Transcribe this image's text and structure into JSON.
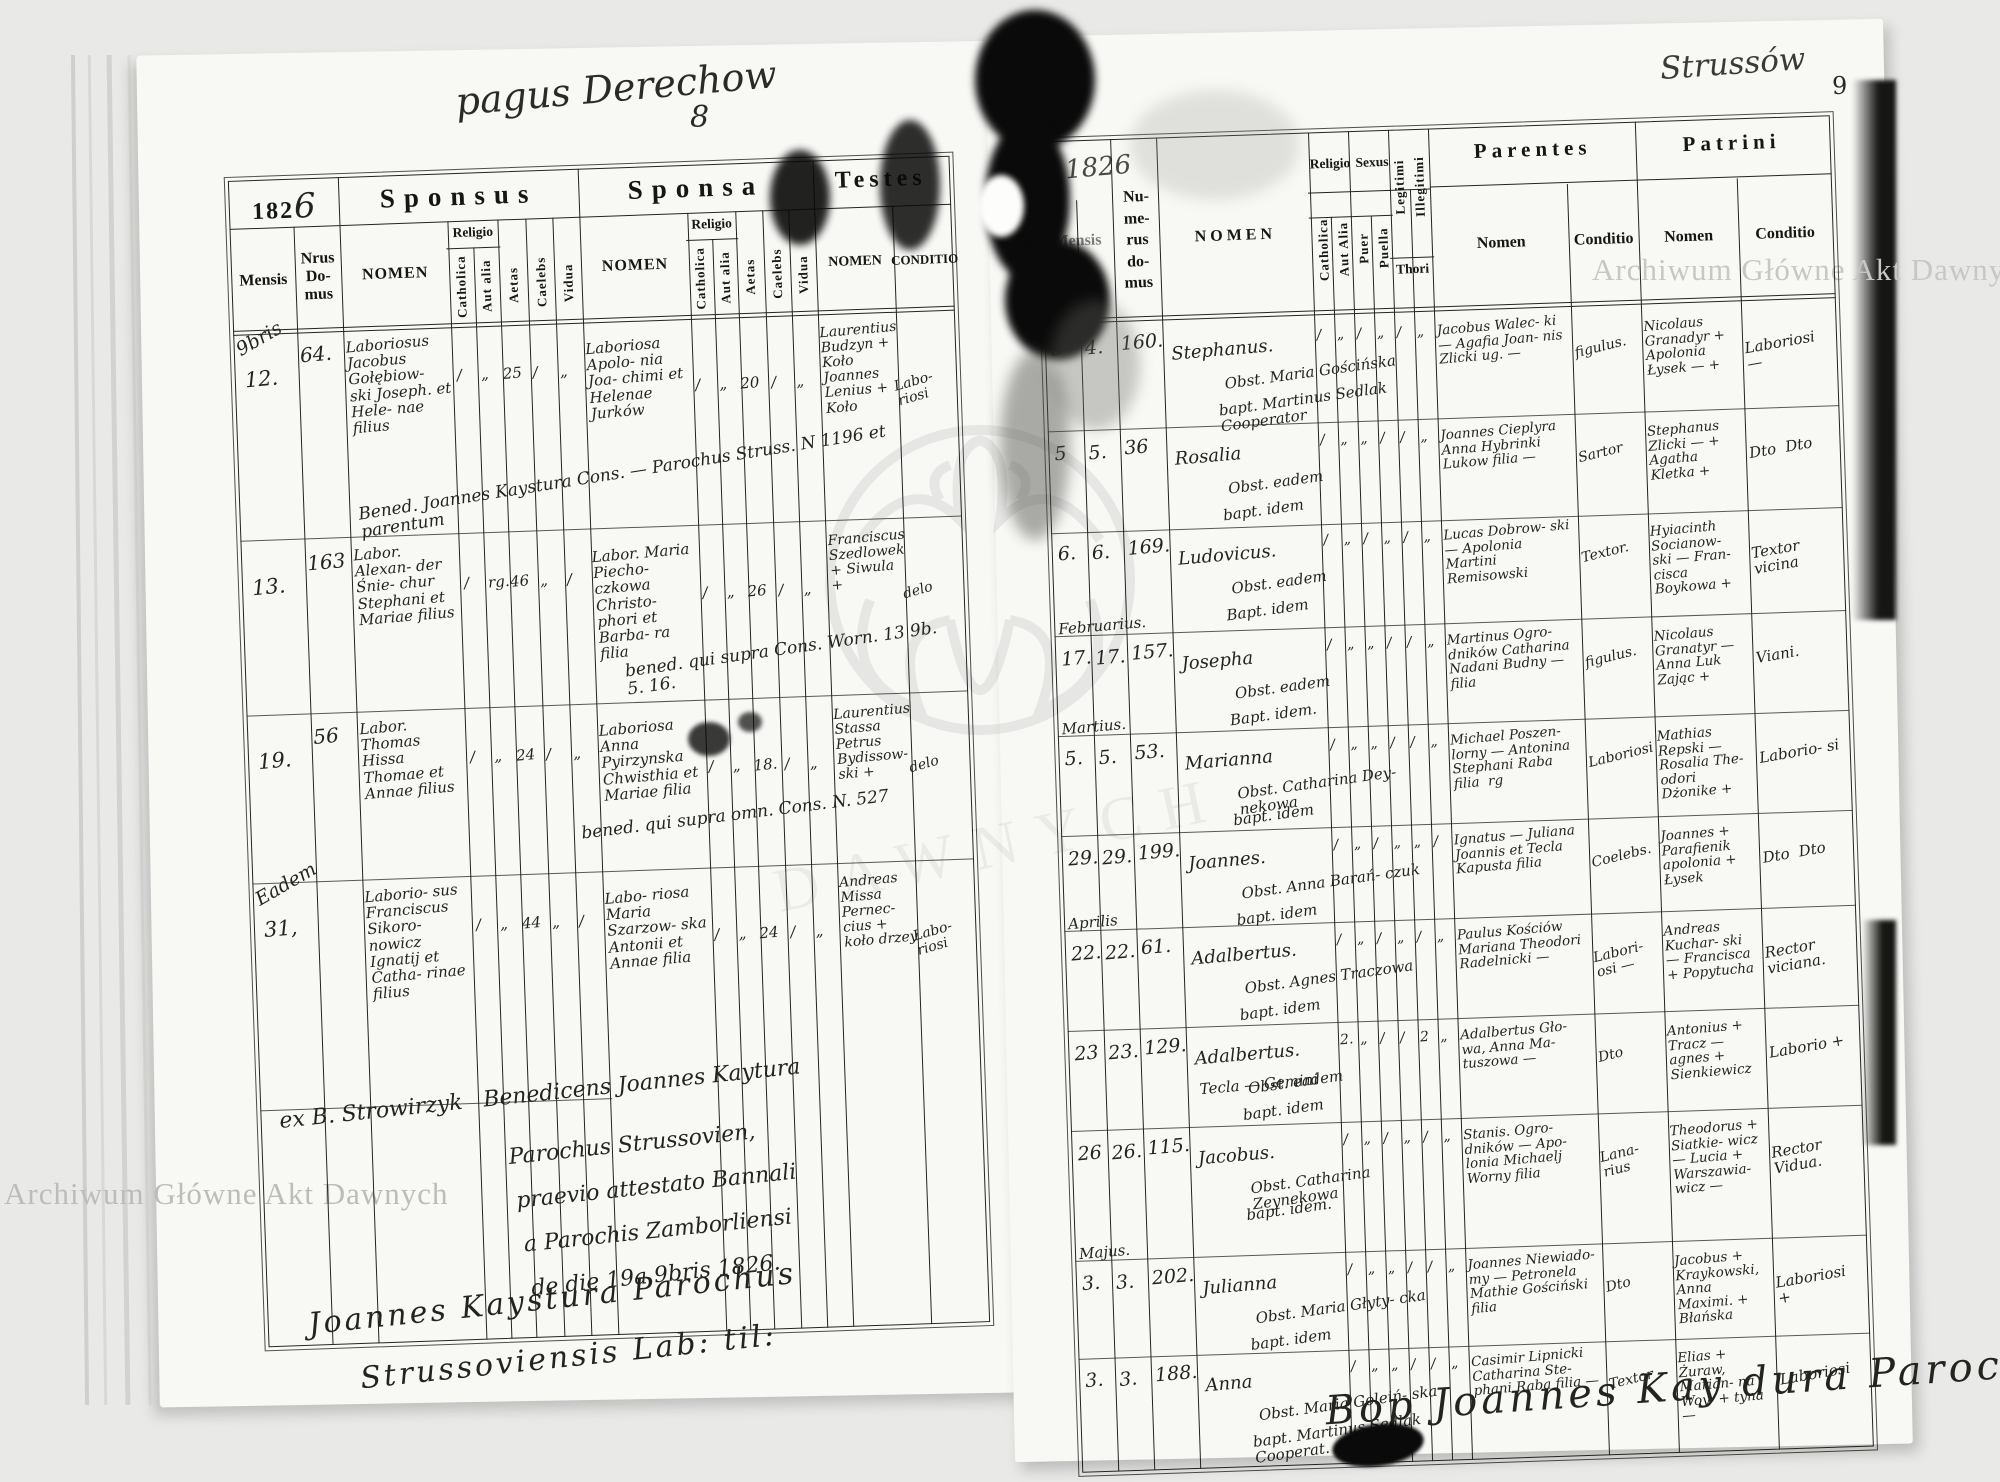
{
  "archive_watermark": "Archiwum Główne Akt Dawnych",
  "watermark_ghost": "DAWNYCH",
  "left_page": {
    "handwritten_title": "pagus Derechow",
    "page_number": "8",
    "year_printed": "182",
    "year_handwritten": "6",
    "sections": {
      "sponsus": "Sponsus",
      "sponsa": "Sponsa",
      "testes": "Testes"
    },
    "headers": {
      "mensis": "Mensis",
      "nrus_domus": "Nrus Do- mus",
      "nomen": "NOMEN",
      "religio": "Religio",
      "catholica": "Catholica",
      "aut_alia": "Aut alia",
      "aetas": "Aetas",
      "caelebs": "Caelebs",
      "vidua": "Vidua",
      "conditio": "CONDITIO"
    },
    "rows": [
      {
        "month": "9bris",
        "day": "12.",
        "house": "64.",
        "sponsus": "Laboriosus Jacobus Gołębiow- ski Joseph. et Hele- nae filius",
        "sp_marks": [
          "/",
          "„",
          "25",
          "/",
          "„"
        ],
        "sponsa": "Laboriosa Apolo- nia Joa- chimi et Helenae Jurków",
        "sa_marks": [
          "/",
          "„",
          "20",
          "/",
          "„"
        ],
        "testes": "Laurentius Budzyn + Koło Joannes Lenius + Koło",
        "conditio": "Labo- riosi",
        "note": "Bened. Joannes Kaystura Cons. — Parochus Struss. N 1196 et parentum"
      },
      {
        "month": "",
        "day": "13.",
        "house": "163",
        "sponsus": "Labor. Alexan- der Śnie- chur Stephani et Mariae filius",
        "sp_marks": [
          "/",
          "rg.",
          "46",
          "„",
          "/"
        ],
        "sponsa": "Labor. Maria Piecho- czkowa Christo- phori et Barba- ra filia",
        "sa_marks": [
          "/",
          "„",
          "26",
          "/",
          "„"
        ],
        "testes": "Franciscus Szedlowek + Siwula +",
        "conditio": "delo",
        "note": "bened. qui supra Cons. Worn. 13 9b. 5. 16."
      },
      {
        "month": "",
        "day": "19.",
        "house": "56",
        "sponsus": "Labor. Thomas Hissa Thomae et Annae filius",
        "sp_marks": [
          "/",
          "„",
          "24",
          "/",
          "„"
        ],
        "sponsa": "Laboriosa Anna Pyirzynska Chwisthia et Mariae filia",
        "sa_marks": [
          "/",
          "„",
          "18.",
          "/",
          "„"
        ],
        "testes": "Laurentius Stassa Petrus Bydissow- ski +",
        "conditio": "delo",
        "note": "bened. qui supra omn. Cons. N. 527"
      },
      {
        "month": "Eadem",
        "day": "31,",
        "house": "",
        "sponsus": "Laborio- sus Franciscus Sikoro- nowicz Ignatij et Catha- rinae filius",
        "sp_marks": [
          "/",
          "„",
          "44",
          "„",
          "/"
        ],
        "sponsa": "Labo- riosa Maria Szarzow- ska Antonii et Annae filia",
        "sa_marks": [
          "/",
          "„",
          "24",
          "/",
          "„"
        ],
        "testes": "Andreas Missa Pernec- cius + koło drzey",
        "conditio": "Labo- riosi",
        "note": ""
      }
    ],
    "footer_lines": [
      "ex B. Strowirzyk   Benedicens Joannes Kaytura",
      "Parochus Strussovien,",
      "praevio attestato Bannali",
      "a Parochis Zamborliensi",
      "de die 19a 9bris 1826."
    ],
    "signature_lines": [
      "Joannes Kaystura Parochus",
      "Strussoviensis Lab: til:"
    ]
  },
  "right_page": {
    "handwritten_title": "Strussów",
    "page_number": "9",
    "year_handwritten": "1826",
    "sections": {
      "parentes": "Parentes",
      "patrini": "Patrini"
    },
    "headers": {
      "mensis": "Mensis",
      "numerus_domus": "Nu- me- rus do- mus",
      "nomen": "NOMEN",
      "religio": "Religio",
      "sexus": "Sexus",
      "catholica": "Catholica",
      "aut_alia": "Aut Alia",
      "puer": "Puer",
      "puella": "Puella",
      "legitimi": "Legitimi",
      "illegitimi": "Illegitimi",
      "thori": "Thori",
      "nomen_sub": "Nomen",
      "conditio_sub": "Conditio"
    },
    "rows": [
      {
        "month": "",
        "day1": "3",
        "day2": "4.",
        "house": "160.",
        "nomen": "Stephanus.",
        "nomen2": "",
        "marks": [
          "/",
          "„",
          "/",
          "„",
          "/",
          "„"
        ],
        "obst": "Obst. Maria Gościńska",
        "bapt": "bapt. Martinus Sedlak Cooperator",
        "parentes": "Jacobus Walec- ki — Agafia Joan- nis Zlicki ug. —",
        "par_cond": "figulus.",
        "patrini": "Nicolaus Granadyr + Apolonia Łysek — +",
        "pat_cond": "Laboriosi —"
      },
      {
        "month": "",
        "day1": "5",
        "day2": "5.",
        "house": "36",
        "nomen": "Rosalia",
        "nomen2": "",
        "marks": [
          "/",
          "„",
          "„",
          "/",
          "/",
          "„"
        ],
        "obst": "Obst. eadem",
        "bapt": "bapt. idem",
        "parentes": "Joannes Cieplyra Anna Hybrinki Lukow filia —",
        "par_cond": "Sartor",
        "patrini": "Stephanus Zlicki — + Agatha Kletka +",
        "pat_cond": "Dto  Dto"
      },
      {
        "month": "",
        "day1": "6.",
        "day2": "6.",
        "house": "169.",
        "nomen": "Ludovicus.",
        "nomen2": "",
        "marks": [
          "/",
          "„",
          "/",
          "„",
          "/",
          "„"
        ],
        "obst": "Obst. eadem",
        "bapt": "Bapt. idem",
        "parentes": "Lucas Dobrow- ski — Apolonia Martini Remisowski",
        "par_cond": "Textor.",
        "patrini": "Hyiacinth Socianow- ski — Fran- cisca Boykowa +",
        "pat_cond": "Textor vicina"
      },
      {
        "month": "Februarius.",
        "day1": "17.",
        "day2": "17.",
        "house": "157.",
        "nomen": "Josepha",
        "nomen2": "",
        "marks": [
          "/",
          "„",
          "„",
          "/",
          "/",
          "„"
        ],
        "obst": "Obst. eadem",
        "bapt": "Bapt. idem.",
        "parentes": "Martinus Ogro- dników Catharina Nadani Budny — filia",
        "par_cond": "figulus.",
        "patrini": "Nicolaus Granatyr — Anna Luk Zając +",
        "pat_cond": "Viani."
      },
      {
        "month": "Martius.",
        "day1": "5.",
        "day2": "5.",
        "house": "53.",
        "nomen": "Marianna",
        "nomen2": "",
        "marks": [
          "/",
          "„",
          "„",
          "/",
          "/",
          "„"
        ],
        "obst": "Obst. Catharina Dey- nekowa",
        "bapt": "bapt. idem",
        "parentes": "Michael Poszen- lorny — Antonina Stephani Raba filia  rg",
        "par_cond": "Laboriosi",
        "patrini": "Mathias Repski — Rosalia The- odori Dżonike +",
        "pat_cond": "Laborio- si"
      },
      {
        "month": "",
        "day1": "29.",
        "day2": "29.",
        "house": "199.",
        "nomen": "Joannes.",
        "nomen2": "",
        "marks": [
          "/",
          "„",
          "/",
          "„",
          "„",
          "/"
        ],
        "obst": "Obst. Anna Barań- czuk",
        "bapt": "bapt. idem",
        "parentes": "Ignatus — Juliana Joannis et Tecla Kapusta filia",
        "par_cond": "Coelebs.",
        "patrini": "Joannes + Parafienik apolonia + Łysek",
        "pat_cond": "Dto  Dto"
      },
      {
        "month": "Aprilis",
        "day1": "22.",
        "day2": "22.",
        "house": "61.",
        "nomen": "Adalbertus.",
        "nomen2": "",
        "marks": [
          "/",
          "„",
          "/",
          "„",
          "/",
          "„"
        ],
        "obst": "Obst. Agnes Traczowa",
        "bapt": "bapt. idem",
        "parentes": "Paulus Kościów Mariana Theodori Radelnicki —",
        "par_cond": "Labori- osi —",
        "patrini": "Andreas Kuchar- ski — Francisca + Popytucha",
        "pat_cond": "Rector viciana."
      },
      {
        "month": "",
        "day1": "23",
        "day2": "23.",
        "house": "129.",
        "nomen": "Adalbertus.",
        "nomen2": "Tecla — Gemini",
        "marks": [
          "2.",
          "„",
          "/",
          "/",
          "2",
          "„"
        ],
        "obst": "Obst. eadem",
        "bapt": "bapt. idem",
        "parentes": "Adalbertus Gło- wa, Anna Ma- tuszowa —",
        "par_cond": "Dto",
        "patrini": "Antonius + Tracz — agnes + Sienkiewicz",
        "pat_cond": "Laborio +"
      },
      {
        "month": "",
        "day1": "26",
        "day2": "26.",
        "house": "115.",
        "nomen": "Jacobus.",
        "nomen2": "",
        "marks": [
          "/",
          "„",
          "/",
          "„",
          "/",
          "„"
        ],
        "obst": "Obst. Catharina Zeynekowa",
        "bapt": "bapt. idem.",
        "parentes": "Stanis. Ogro- dników — Apo- lonia Michaelj Worny filia",
        "par_cond": "Lana- rius",
        "patrini": "Theodorus + Siatkie- wicz — Lucia + Warszawia- wicz —",
        "pat_cond": "Rector Vidua."
      },
      {
        "month": "Majus.",
        "day1": "3.",
        "day2": "3.",
        "house": "202.",
        "nomen": "Julianna",
        "nomen2": "",
        "marks": [
          "/",
          "„",
          "„",
          "/",
          "/",
          "„"
        ],
        "obst": "Obst. Maria Głyty- cka",
        "bapt": "bapt. idem",
        "parentes": "Joannes Niewiado- my — Petronela Mathie Gościński filia",
        "par_cond": "Dto",
        "patrini": "Jacobus + Kraykowski, Anna Maximi. + Błańska",
        "pat_cond": "Laboriosi +"
      },
      {
        "month": "",
        "day1": "3.",
        "day2": "3.",
        "house": "188.",
        "nomen": "Anna",
        "nomen2": "",
        "marks": [
          "/",
          "„",
          "„",
          "/",
          "/",
          "„"
        ],
        "obst": "Obst. Maria Goleiń- ska",
        "bapt": "bapt. Martinus Sedlak Cooperat.",
        "parentes": "Casimir Lipnicki Catharina Ste- phani Raba filia —",
        "par_cond": "Textor",
        "patrini": "Elias + Żuraw, Marian- na Woy- + tyna —",
        "pat_cond": "Laboriosi"
      }
    ],
    "signature": "Bop Joannes Kay dura   Parochus"
  }
}
